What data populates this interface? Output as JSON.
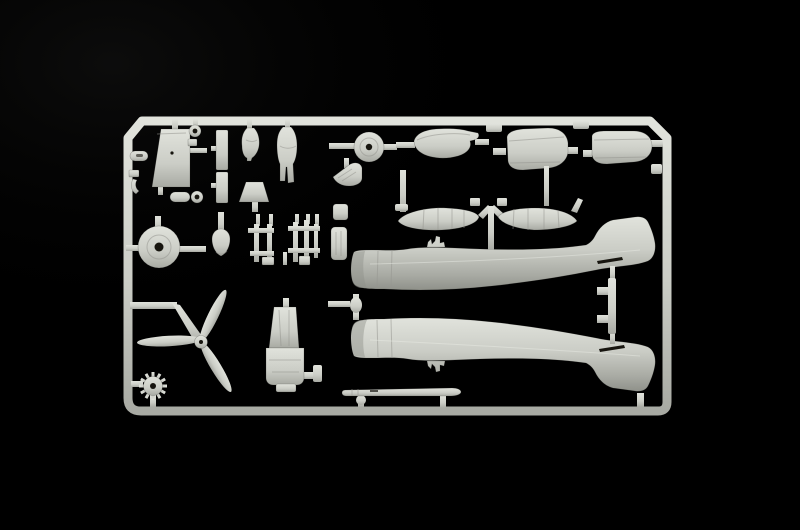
{
  "scene": {
    "description": "Photograph of a light grey injection-molded plastic model kit sprue (aircraft parts tree) on a black background",
    "colors": {
      "bg": "#000000",
      "plastic_hi": "#e1e3dc",
      "plastic_mid": "#cbcdc6",
      "plastic_lo": "#a8aaa3",
      "plastic_deep": "#8f918a",
      "detail_dark": "#17150f",
      "panel_line": "#96968f"
    }
  },
  "parts": [
    {
      "id": "sprue-frame",
      "label": "Sprue frame with chamfered top corners"
    },
    {
      "id": "canopy-panel",
      "label": "Trapezoid flat panel part"
    },
    {
      "id": "strip-parts",
      "label": "Two rectangular strip parts"
    },
    {
      "id": "pilot-figure-seated",
      "label": "Seated pilot figure torso"
    },
    {
      "id": "pilot-figure-standing",
      "label": "Standing pilot figure"
    },
    {
      "id": "windscreen-part",
      "label": "Trapezoid windscreen part"
    },
    {
      "id": "small-wheel",
      "label": "Small wheel disc with hub hole"
    },
    {
      "id": "hull-part",
      "label": "Hull-shaped cowl part"
    },
    {
      "id": "cowling-panel-left",
      "label": "Rounded engine cowling panel (left)"
    },
    {
      "id": "cowling-panel-right",
      "label": "Rounded engine cowling panel (right)"
    },
    {
      "id": "drop-tank-left",
      "label": "Ribbed drop tank (left)"
    },
    {
      "id": "drop-tank-right",
      "label": "Ribbed drop tank (right)"
    },
    {
      "id": "main-wheel",
      "label": "Main wheel disc with center hole"
    },
    {
      "id": "spinner",
      "label": "Propeller spinner cone"
    },
    {
      "id": "landing-gear-struts",
      "label": "Landing gear strut ladder parts"
    },
    {
      "id": "cowl-flap-parts",
      "label": "Small rounded rectangular inserts"
    },
    {
      "id": "propeller",
      "label": "Three-blade propeller"
    },
    {
      "id": "engine-fan",
      "label": "Toothed engine cooling fan wheel"
    },
    {
      "id": "cockpit-tub",
      "label": "Cockpit tub with seat"
    },
    {
      "id": "gun-barrel",
      "label": "Long thin gun barrel / pitot part"
    },
    {
      "id": "fuselage-half-upper",
      "label": "Fuselage half, fin up (nose left)"
    },
    {
      "id": "fuselage-half-lower",
      "label": "Fuselage half, mirrored, fin down"
    },
    {
      "id": "small-fittings",
      "label": "Small rings, links, hooks and brackets on left rail"
    }
  ]
}
